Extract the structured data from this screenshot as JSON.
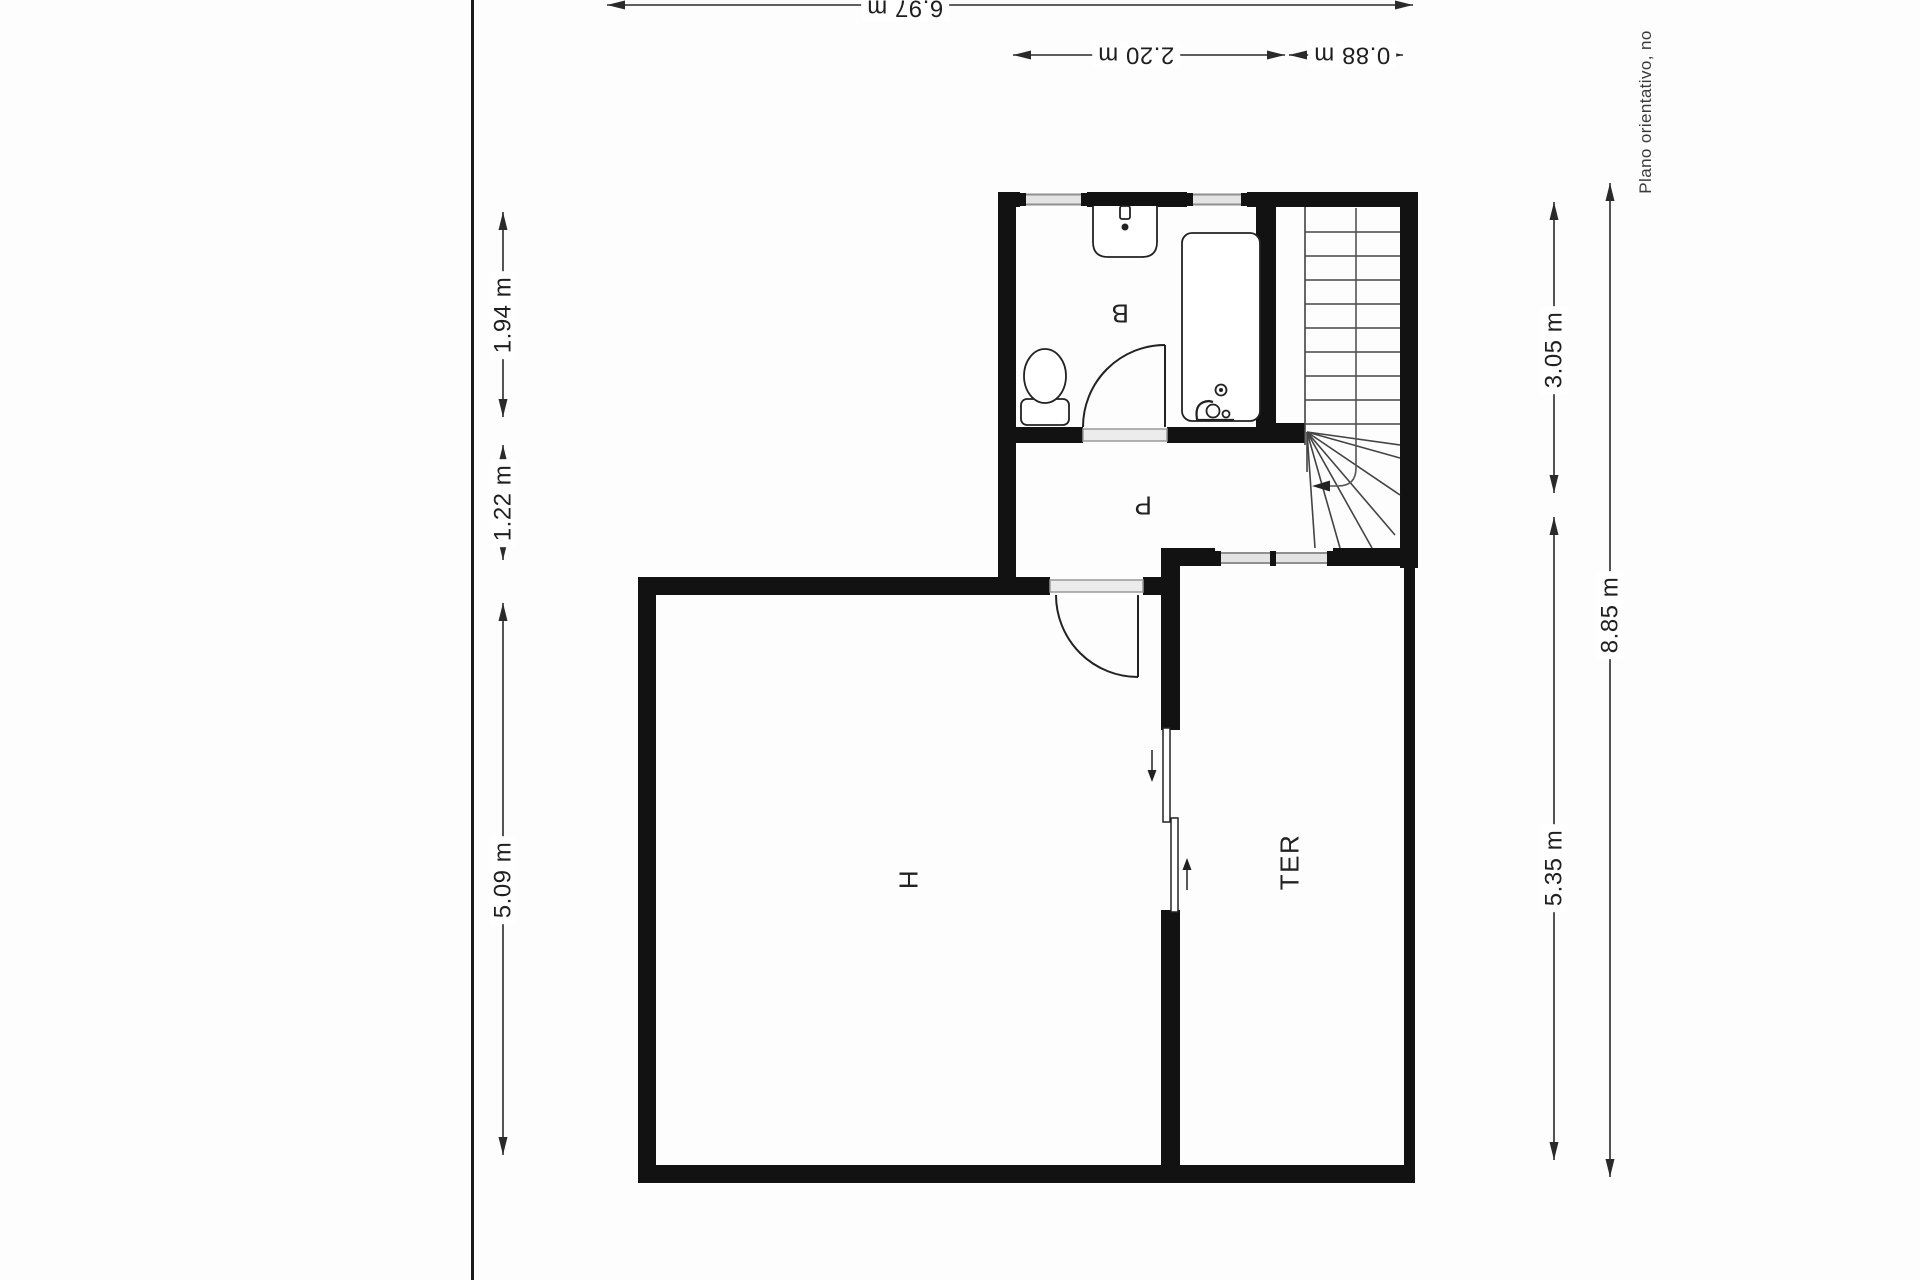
{
  "plan": {
    "room_labels": {
      "bathroom": "B",
      "hallway": "P",
      "bedroom": "H",
      "terrace": "TER"
    },
    "dimensions": {
      "top_overall": "6.97 m",
      "top_bathroom": "2.20 m",
      "top_stairs": "0.88 m",
      "left_bathroom": "1.94 m",
      "left_hallway": "1.22 m",
      "left_bedroom": "5.09 m",
      "right_upper": "3.05 m",
      "right_overall": "8.85 m",
      "right_terrace": "5.35 m"
    },
    "disclaimer": "Plano orientativo, no",
    "colors": {
      "wall": "#121212",
      "line": "#2a2a2a",
      "glazing_fill": "#e3e3e3",
      "glazing_stroke": "#8f8f8f",
      "text": "#1f1f1f"
    }
  }
}
